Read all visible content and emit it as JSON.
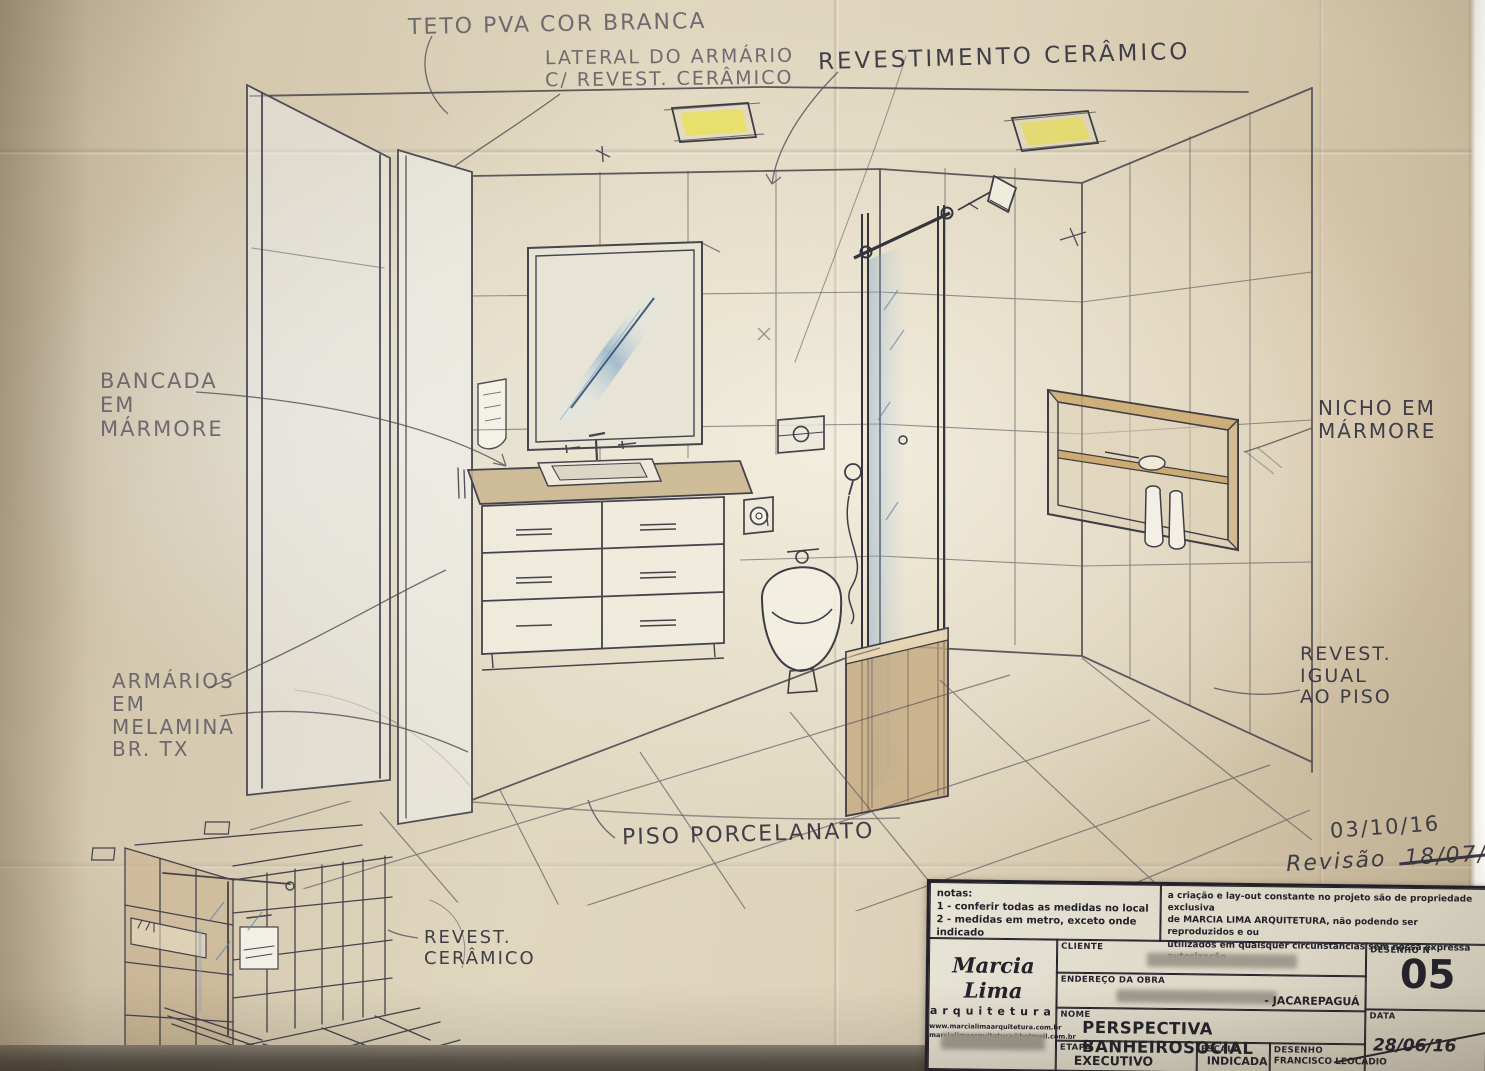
{
  "drawing_title": "PERSPECTIVA BANHEIRO SOCIAL",
  "annotations": {
    "teto": {
      "l1": "TETO PVA COR BRANCA"
    },
    "lateral": {
      "l1": "LATERAL DO ARMÁRIO",
      "l2": "C/ REVEST. CERÂMICO"
    },
    "revestimento": {
      "l1": "REVESTIMENTO CERÂMICO"
    },
    "bancada": {
      "l1": "BANCADA",
      "l2": "EM",
      "l3": "MÁRMORE"
    },
    "nicho": {
      "l1": "NICHO EM",
      "l2": "MÁRMORE"
    },
    "armarios": {
      "l1": "ARMÁRIOS",
      "l2": "EM",
      "l3": "MELAMINA",
      "l4": "BR. TX"
    },
    "revest_igual": {
      "l1": "REVEST.",
      "l2": "IGUAL",
      "l3": "AO PISO"
    },
    "piso": {
      "l1": "PISO PORCELANATO"
    },
    "revest_ceramico": {
      "l1": "REVEST.",
      "l2": "CERÂMICO"
    },
    "data_anotada": "03/10/16",
    "revisao_label": "Revisão",
    "revisao_data": "18/07/16"
  },
  "titleblock": {
    "notes": {
      "title": "notas:",
      "n1": "1 - conferir todas as medidas no local",
      "n2": "2 - medidas em metro, exceto onde indicado"
    },
    "copyright": {
      "l1": "a criação e lay-out constante no projeto são de propriedade exclusiva",
      "l2": "de MARCIA LIMA ARQUITETURA, não podendo ser reproduzidos e ou",
      "l3": "utilizados em quaisquer circunstâncias sem nossa expressa autorização."
    },
    "logo": {
      "name": "Marcia Lima",
      "sub": "arquitetura",
      "web1": "www.marcialimaarquitetura.com.br",
      "web2": "marcialimaarquitetura@hotmail.com.br"
    },
    "fields": {
      "cliente_label": "CLIENTE",
      "endereco_label": "ENDEREÇO DA OBRA",
      "endereco_value": "- JACAREPAGUÁ",
      "nome_label": "NOME",
      "nome_value": "PERSPECTIVA BANHEIROSOCIAL",
      "etapa_label": "ETAPA",
      "etapa_value": "EXECUTIVO",
      "escala_label": "ESCALA",
      "escala_value": "INDICADA",
      "desenhista_label": "DESENHO",
      "desenhista_value": "FRANCISCO LEOCÁDIO",
      "numero_label": "DESENHO N°",
      "numero_value": "05",
      "data_label": "DATA",
      "data_value": "28/06/16"
    }
  },
  "colors": {
    "paper": "#e0d7bf",
    "pencil": "#57545f",
    "ink": "#33323e",
    "blue_glass": "#7fa6c9",
    "ceiling_light_yellow": "#e9df63",
    "marble_tan": "#c9b48e",
    "niche_wood": "#c8a05e"
  }
}
